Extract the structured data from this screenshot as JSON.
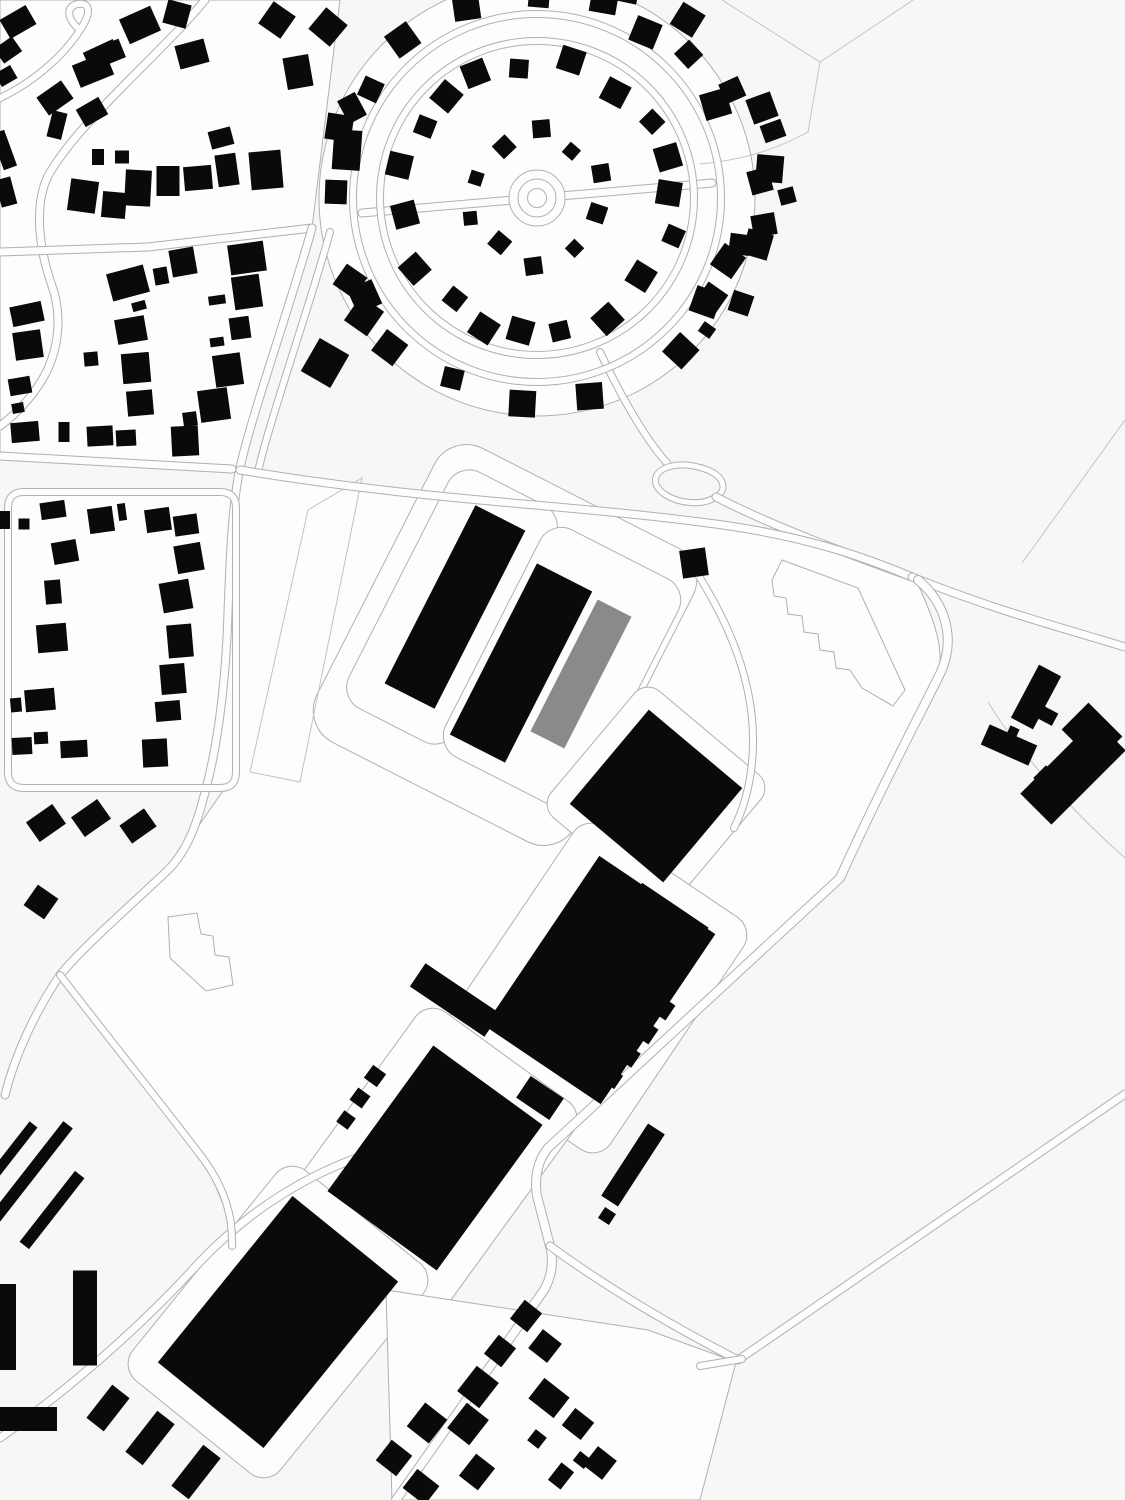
{
  "page": {
    "kind": "figure-ground-site-plan"
  },
  "colors": {
    "background": "#f7f7f8",
    "parcel": "#fdfdfe",
    "line": "#b0b0b5",
    "fieldline": "#c3c3c8",
    "building": "#0a0a0a",
    "highlight": "#8a8a8a"
  },
  "map": {
    "width": 1125,
    "height": 1500,
    "parcels": [
      {
        "poly": "M0,0 L340,0 L312,228 L148,247 L52,252 L0,252 Z"
      },
      {
        "poly": "M0,252 L148,247 L312,228 L240,468 L0,456 Z"
      },
      {
        "poly": "M240,470 C420,500 560,504 700,522 C800,534 880,560 915,578 C935,620 945,650 938,678 C918,718 880,790 840,878 L548,1148 L396,1290 L240,1246 L205,1160 L60,975 L168,870 L236,772 L236,508 Z"
      },
      {
        "circle": [
          537,
          198,
          218
        ]
      },
      {
        "rect": [
          122,
          640,
          228,
          296,
          0
        ],
        "rx": 14
      },
      {
        "rect": [
          505,
          645,
          290,
          330,
          27
        ],
        "rx": 36
      },
      {
        "rect": [
          452,
          607,
          120,
          265,
          27
        ],
        "rx": 24
      },
      {
        "rect": [
          562,
          668,
          155,
          255,
          27
        ],
        "rx": 24
      },
      {
        "rect": [
          656,
          796,
          165,
          165,
          40
        ],
        "rx": 18
      },
      {
        "rect": [
          592,
          988,
          205,
          280,
          34
        ],
        "rx": 22
      },
      {
        "rect": [
          432,
          1160,
          195,
          255,
          36
        ],
        "rx": 22
      },
      {
        "rect": [
          278,
          1322,
          190,
          270,
          39
        ],
        "rx": 22
      },
      {
        "poly": "M386,1290 L648,1330 L736,1362 L700,1500 L392,1500 Z"
      }
    ],
    "field_lines": [
      "M722,0 L820,62 L913,0",
      "M820,62 L808,132 C772,152 735,161 700,164",
      "M308,510 L362,478 L300,782 L250,772 Z",
      "M1125,420 L1022,563",
      "M988,702 C1012,742 1062,802 1125,858"
    ],
    "roads": [
      {
        "d": "M205,0 C160,55 78,122 48,176 C33,207 40,252 52,286 C62,314 60,350 42,380 C26,406 8,420 0,426",
        "w": 7
      },
      {
        "d": "M0,98 C38,80 66,52 80,30 C92,12 90,2 78,4 C66,6 66,18 80,30",
        "w": 6
      },
      {
        "d": "M0,252 L148,247 L312,228",
        "w": 7
      },
      {
        "d": "M312,228 C292,300 250,420 240,468 C232,505 230,560 228,612 C226,680 218,744 206,788 C197,826 186,852 168,870 C128,908 85,945 60,975 C35,1012 15,1055 5,1095",
        "w": 7
      },
      {
        "d": "M330,232 C310,305 268,425 258,472",
        "w": 6
      },
      {
        "d": "M0,456 L232,469",
        "w": 7
      },
      {
        "d": "M24,492 L220,492 Q236,492 236,508 L236,772 Q236,788 220,788 L24,788 Q8,788 8,772 L8,508 Q8,492 24,492 Z",
        "w": 6
      },
      {
        "d": "M362,213 L712,183",
        "w": 7
      },
      {
        "d": "M600,352 C625,405 650,445 668,464",
        "w": 6
      },
      {
        "d": "M672,466 C654,470 650,483 663,493 C678,504 702,506 716,497 C729,489 723,475 705,469 C693,465 681,464 672,466 Z",
        "w": 5
      },
      {
        "d": "M716,497 C770,525 845,553 912,577",
        "w": 7
      },
      {
        "d": "M240,470 C420,500 560,504 700,522 C800,534 862,556 912,577",
        "w": 7
      },
      {
        "d": "M912,577 C1000,612 1060,627 1125,647",
        "w": 7
      },
      {
        "d": "M918,580 C945,602 958,640 938,678 C918,718 880,790 840,878 L548,1148 C538,1160 534,1177 537,1196 L550,1246 C554,1262 552,1276 544,1290 L396,1500",
        "w": 8
      },
      {
        "d": "M550,1246 C610,1290 680,1330 738,1360 L1125,1094",
        "w": 7
      },
      {
        "d": "M700,1366 L742,1359",
        "w": 6
      },
      {
        "d": "M695,570 C722,612 740,652 748,692 C758,740 753,790 734,828",
        "w": 6
      },
      {
        "d": "M0,1438 C75,1385 145,1322 196,1266 C248,1210 310,1172 374,1152",
        "w": 7
      },
      {
        "d": "M60,975 C110,1040 168,1112 204,1160 C224,1188 233,1215 232,1246",
        "w": 6
      }
    ],
    "estate": {
      "center": [
        537,
        198
      ],
      "ring_roads": [
        157,
        184
      ],
      "roundabout_radii": [
        28,
        19,
        9.5
      ],
      "house_rings": [
        {
          "r": 64,
          "count": 10,
          "start": -162,
          "size": 16
        },
        {
          "r": 136,
          "count": 19,
          "start": -170,
          "size": 22
        },
        {
          "r": 204,
          "count": 21,
          "start": -178,
          "size": 24,
          "skip": [
            0,
            10,
            14,
            20
          ]
        },
        {
          "r": 229,
          "count": 7,
          "start": -82,
          "span": 108,
          "size": 24
        }
      ]
    },
    "outline_buildings": [
      "M782,560 L858,588 L905,690 L893,706 L862,688 L850,670 L836,668 L834,652 L820,650 L818,634 L804,632 L802,616 L788,614 L786,598 L774,596 L772,580 Z",
      "M168,917 L197,913 L201,934 L213,936 L215,955 L229,957 L233,985 L206,991 L170,958 Z"
    ],
    "buildings": [
      [
        18,
        22,
        30,
        22,
        -30
      ],
      [
        8,
        50,
        22,
        18,
        -35
      ],
      [
        6,
        76,
        18,
        15,
        -30
      ],
      [
        4,
        150,
        14,
        38,
        -20
      ],
      [
        6,
        192,
        16,
        28,
        -15
      ],
      [
        93,
        70,
        36,
        24,
        -22
      ],
      [
        112,
        52,
        22,
        20,
        -22
      ],
      [
        140,
        25,
        34,
        27,
        -24
      ],
      [
        177,
        14,
        24,
        24,
        15
      ],
      [
        192,
        54,
        30,
        24,
        -15
      ],
      [
        277,
        20,
        27,
        27,
        35
      ],
      [
        328,
        27,
        28,
        28,
        40
      ],
      [
        298,
        72,
        26,
        32,
        -10
      ],
      [
        352,
        108,
        20,
        26,
        -28
      ],
      [
        347,
        150,
        28,
        40,
        4
      ],
      [
        336,
        192,
        22,
        24,
        2
      ],
      [
        55,
        98,
        30,
        22,
        -35
      ],
      [
        57,
        125,
        15,
        27,
        14
      ],
      [
        92,
        112,
        26,
        20,
        -30
      ],
      [
        102,
        55,
        33,
        20,
        -25
      ],
      [
        83,
        196,
        28,
        32,
        8
      ],
      [
        114,
        205,
        24,
        26,
        5
      ],
      [
        138,
        188,
        26,
        36,
        3
      ],
      [
        168,
        181,
        23,
        30,
        0
      ],
      [
        198,
        178,
        28,
        24,
        -5
      ],
      [
        227,
        170,
        21,
        32,
        -8
      ],
      [
        266,
        170,
        32,
        38,
        -5
      ],
      [
        221,
        138,
        23,
        18,
        -15
      ],
      [
        98,
        157,
        12,
        16,
        0
      ],
      [
        122,
        157,
        14,
        13,
        0
      ],
      [
        27,
        314,
        32,
        20,
        -12
      ],
      [
        28,
        345,
        28,
        28,
        -8
      ],
      [
        20,
        386,
        22,
        17,
        -10
      ],
      [
        18,
        408,
        12,
        10,
        -10
      ],
      [
        25,
        432,
        28,
        20,
        -5
      ],
      [
        64,
        432,
        11,
        20,
        0
      ],
      [
        100,
        436,
        26,
        20,
        -3
      ],
      [
        126,
        438,
        20,
        16,
        -3
      ],
      [
        185,
        441,
        27,
        30,
        -3
      ],
      [
        128,
        283,
        38,
        28,
        -15
      ],
      [
        139,
        306,
        14,
        9,
        -15
      ],
      [
        161,
        276,
        14,
        17,
        -10
      ],
      [
        183,
        262,
        25,
        27,
        -10
      ],
      [
        131,
        330,
        30,
        25,
        -10
      ],
      [
        136,
        368,
        28,
        30,
        -5
      ],
      [
        140,
        403,
        26,
        25,
        -5
      ],
      [
        91,
        359,
        14,
        14,
        -5
      ],
      [
        217,
        300,
        17,
        9,
        -8
      ],
      [
        217,
        342,
        14,
        9,
        -8
      ],
      [
        247,
        258,
        36,
        30,
        -8
      ],
      [
        247,
        292,
        28,
        33,
        -8
      ],
      [
        240,
        328,
        20,
        22,
        -8
      ],
      [
        228,
        370,
        28,
        32,
        -8
      ],
      [
        214,
        405,
        30,
        32,
        -8
      ],
      [
        190,
        419,
        14,
        14,
        -8
      ],
      [
        350,
        281,
        25,
        25,
        35
      ],
      [
        364,
        316,
        28,
        30,
        35
      ],
      [
        325,
        363,
        34,
        38,
        30
      ],
      [
        53,
        510,
        25,
        17,
        -8
      ],
      [
        101,
        520,
        25,
        25,
        -8
      ],
      [
        122,
        512,
        8,
        17,
        -8
      ],
      [
        158,
        520,
        25,
        23,
        -8
      ],
      [
        186,
        525,
        24,
        20,
        -8
      ],
      [
        189,
        558,
        27,
        28,
        -10
      ],
      [
        176,
        596,
        30,
        30,
        -10
      ],
      [
        180,
        641,
        25,
        33,
        -5
      ],
      [
        173,
        679,
        25,
        30,
        -5
      ],
      [
        168,
        711,
        25,
        20,
        -5
      ],
      [
        155,
        753,
        25,
        28,
        -3
      ],
      [
        65,
        552,
        25,
        22,
        -10
      ],
      [
        53,
        592,
        16,
        24,
        -5
      ],
      [
        52,
        638,
        30,
        28,
        -5
      ],
      [
        40,
        700,
        30,
        22,
        -5
      ],
      [
        16,
        705,
        11,
        14,
        -5
      ],
      [
        22,
        746,
        20,
        17,
        -3
      ],
      [
        41,
        738,
        14,
        12,
        -3
      ],
      [
        74,
        749,
        27,
        17,
        -3
      ],
      [
        5,
        520,
        10,
        18,
        0
      ],
      [
        24,
        524,
        11,
        11,
        0
      ],
      [
        46,
        823,
        32,
        24,
        -35
      ],
      [
        91,
        818,
        32,
        24,
        -35
      ],
      [
        138,
        826,
        30,
        22,
        -35
      ],
      [
        41,
        902,
        25,
        25,
        35
      ],
      [
        762,
        108,
        26,
        26,
        -20
      ],
      [
        773,
        131,
        22,
        18,
        -20
      ],
      [
        760,
        181,
        22,
        24,
        -15
      ],
      [
        787,
        196,
        16,
        16,
        -15
      ],
      [
        764,
        225,
        24,
        22,
        -10
      ],
      [
        728,
        261,
        26,
        26,
        35
      ],
      [
        711,
        299,
        24,
        26,
        35
      ],
      [
        707,
        330,
        14,
        12,
        35
      ],
      [
        694,
        563,
        26,
        28,
        -8
      ],
      [
        455,
        607,
        56,
        200,
        27
      ],
      [
        480,
        562,
        22,
        26,
        27
      ],
      [
        420,
        672,
        30,
        22,
        27
      ],
      [
        433,
        648,
        20,
        18,
        27
      ],
      [
        521,
        663,
        62,
        192,
        27
      ],
      [
        553,
        592,
        20,
        24,
        27
      ],
      [
        492,
        700,
        18,
        28,
        27
      ],
      [
        581,
        674,
        38,
        148,
        27,
        "g"
      ],
      [
        561,
        706,
        20,
        56,
        27,
        "g"
      ],
      [
        656,
        796,
        122,
        123,
        40
      ],
      [
        600,
        980,
        140,
        205,
        34
      ],
      [
        660,
        928,
        80,
        55,
        34
      ],
      [
        455,
        1000,
        90,
        28,
        34
      ],
      [
        540,
        1098,
        40,
        26,
        34
      ],
      [
        663,
        1008,
        18,
        18,
        34
      ],
      [
        646,
        1032,
        18,
        18,
        34
      ],
      [
        629,
        1056,
        17,
        17,
        34
      ],
      [
        612,
        1078,
        16,
        16,
        34
      ],
      [
        435,
        1158,
        135,
        180,
        36
      ],
      [
        375,
        1076,
        16,
        16,
        36
      ],
      [
        360,
        1098,
        15,
        15,
        36
      ],
      [
        346,
        1120,
        14,
        14,
        36
      ],
      [
        492,
        1102,
        28,
        22,
        36
      ],
      [
        278,
        1322,
        136,
        214,
        39
      ],
      [
        633,
        1165,
        20,
        86,
        33
      ],
      [
        621,
        1181,
        12,
        14,
        33
      ],
      [
        607,
        1216,
        13,
        13,
        33
      ],
      [
        1036,
        697,
        25,
        60,
        28
      ],
      [
        1048,
        716,
        16,
        14,
        28
      ],
      [
        1009,
        745,
        52,
        22,
        24
      ],
      [
        1013,
        732,
        10,
        10,
        24
      ],
      [
        1073,
        772,
        44,
        105,
        45
      ],
      [
        1092,
        733,
        48,
        38,
        45
      ],
      [
        1046,
        778,
        18,
        18,
        45
      ],
      [
        25,
        1180,
        12,
        140,
        38
      ],
      [
        52,
        1210,
        12,
        90,
        38
      ],
      [
        12,
        1152,
        10,
        70,
        38
      ],
      [
        8,
        1327,
        16,
        86,
        0
      ],
      [
        85,
        1318,
        24,
        95,
        0
      ],
      [
        28,
        1419,
        58,
        24,
        0
      ],
      [
        108,
        1408,
        22,
        42,
        38
      ],
      [
        150,
        1438,
        22,
        52,
        38
      ],
      [
        196,
        1472,
        22,
        52,
        38
      ],
      [
        526,
        1316,
        22,
        24,
        38
      ],
      [
        545,
        1346,
        24,
        24,
        38
      ],
      [
        500,
        1351,
        22,
        24,
        38
      ],
      [
        478,
        1387,
        28,
        32,
        38
      ],
      [
        427,
        1423,
        28,
        30,
        38
      ],
      [
        468,
        1424,
        28,
        32,
        38
      ],
      [
        549,
        1398,
        32,
        26,
        38
      ],
      [
        578,
        1424,
        24,
        22,
        38
      ],
      [
        537,
        1439,
        14,
        14,
        38
      ],
      [
        561,
        1476,
        16,
        22,
        38
      ],
      [
        582,
        1460,
        14,
        12,
        38
      ],
      [
        600,
        1463,
        24,
        24,
        38
      ],
      [
        477,
        1472,
        24,
        28,
        38
      ],
      [
        421,
        1487,
        28,
        24,
        38
      ],
      [
        394,
        1458,
        26,
        26,
        38
      ]
    ]
  }
}
